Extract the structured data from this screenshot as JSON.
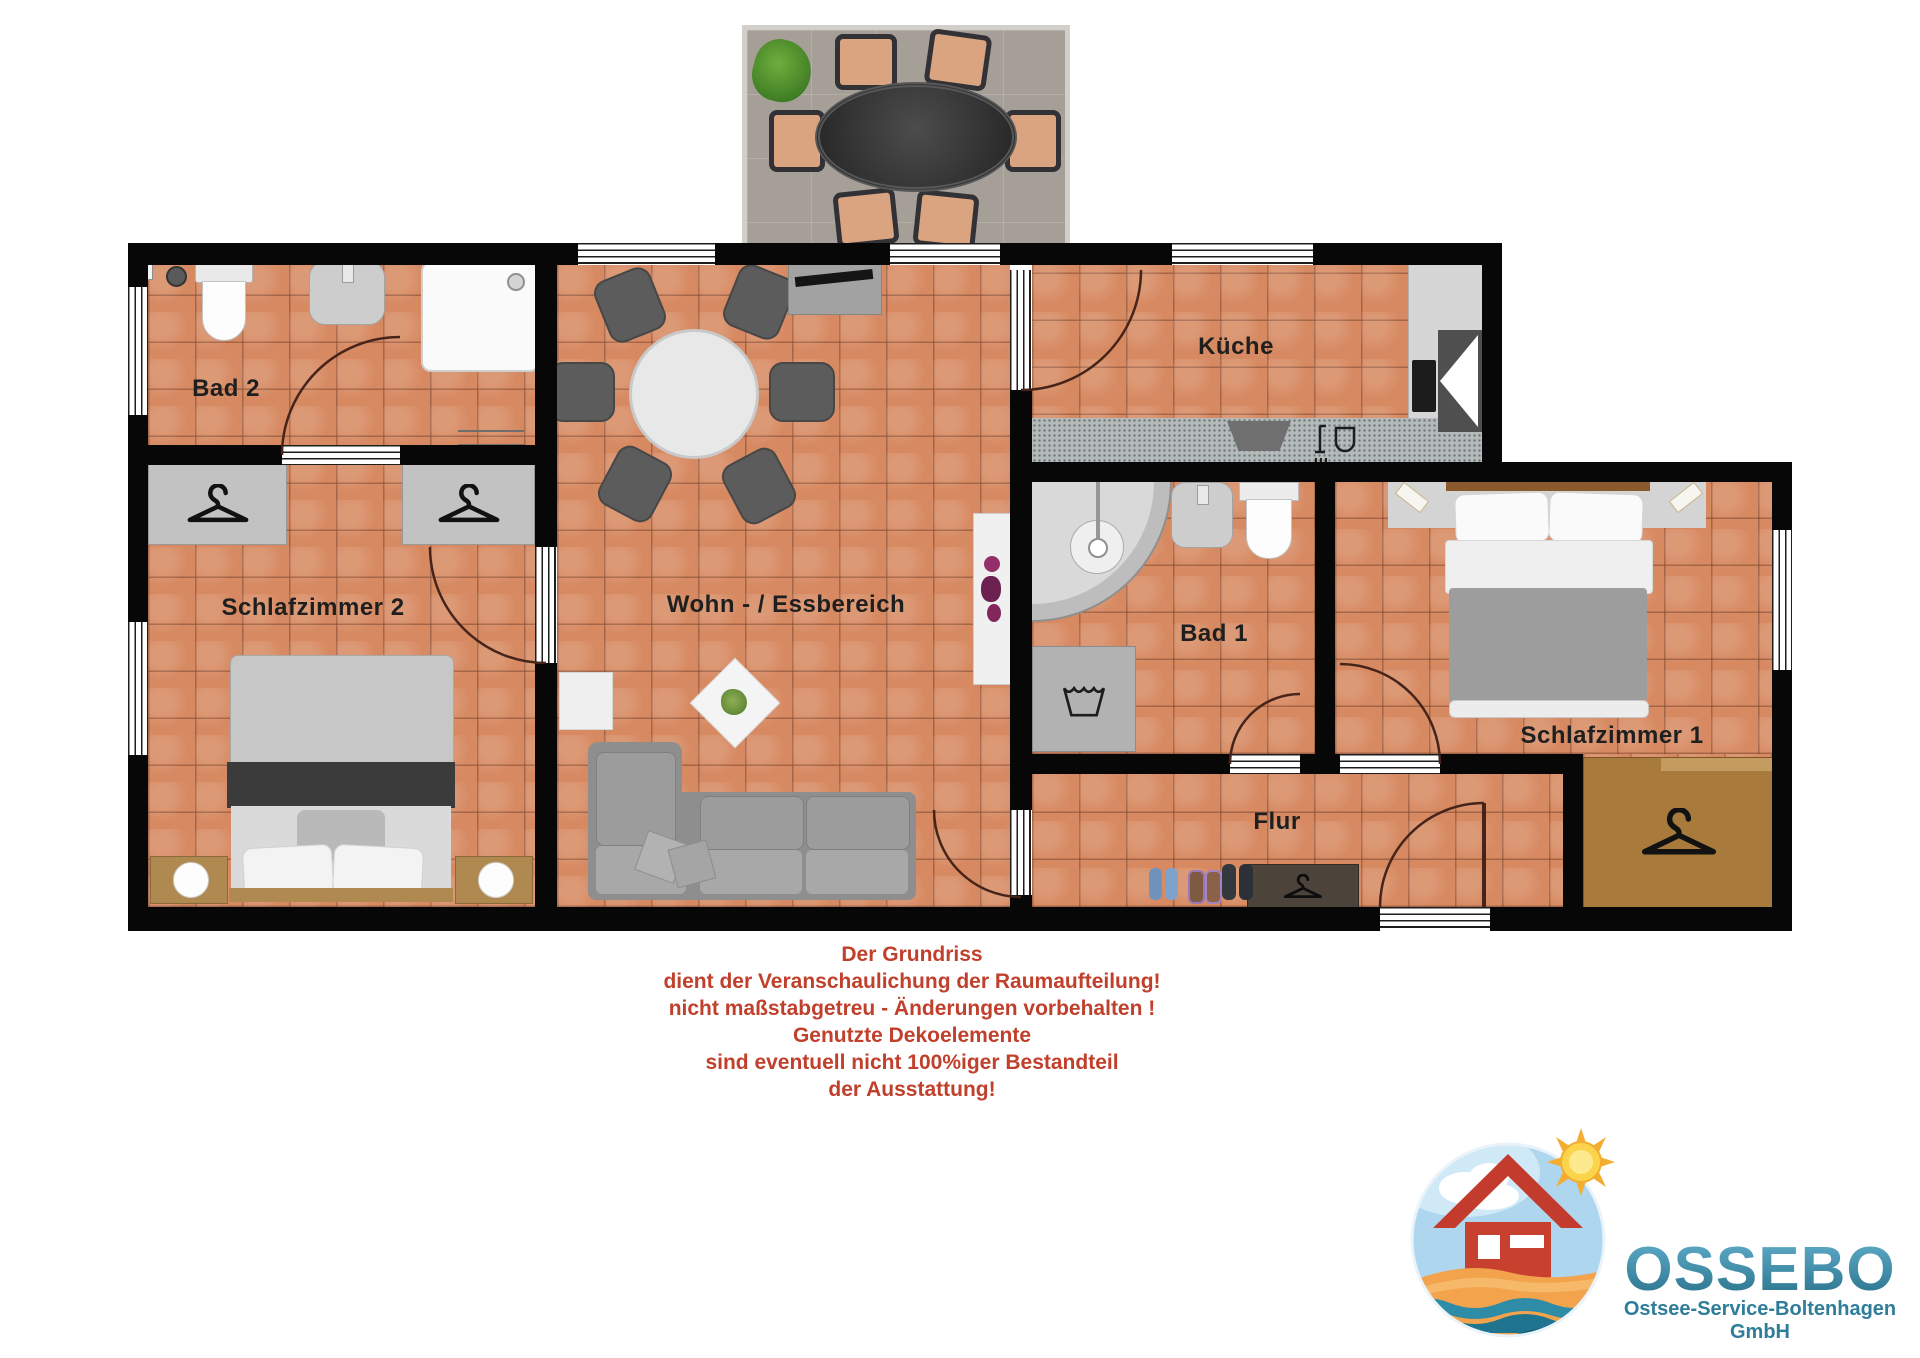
{
  "plan": {
    "rooms": {
      "bad2": {
        "label": "Bad 2"
      },
      "schlafzimmer2": {
        "label": "Schlafzimmer 2"
      },
      "wohnbereich": {
        "label": "Wohn - / Essbereich"
      },
      "kueche": {
        "label": "Küche"
      },
      "bad1": {
        "label": "Bad 1"
      },
      "schlafzimmer1": {
        "label": "Schlafzimmer 1"
      },
      "flur": {
        "label": "Flur"
      }
    },
    "colors": {
      "floor_tile": "#d78a62",
      "wall": "#070707",
      "room_label": "#1f1f1f"
    }
  },
  "disclaimer": {
    "color": "#c0402c",
    "lines": [
      "Der Grundriss",
      "dient der Veranschaulichung der Raumaufteilung!",
      "nicht maßstabgetreu - Änderungen vorbehalten !",
      "Genutzte Dekoelemente",
      "sind eventuell nicht 100%iger Bestandteil",
      "der Ausstattung!"
    ]
  },
  "logo": {
    "brand": "OSSEBO",
    "tagline": "Ostsee-Service-Boltenhagen GmbH",
    "brand_color": "#3a92ae",
    "tagline_color": "#2e7d99"
  }
}
